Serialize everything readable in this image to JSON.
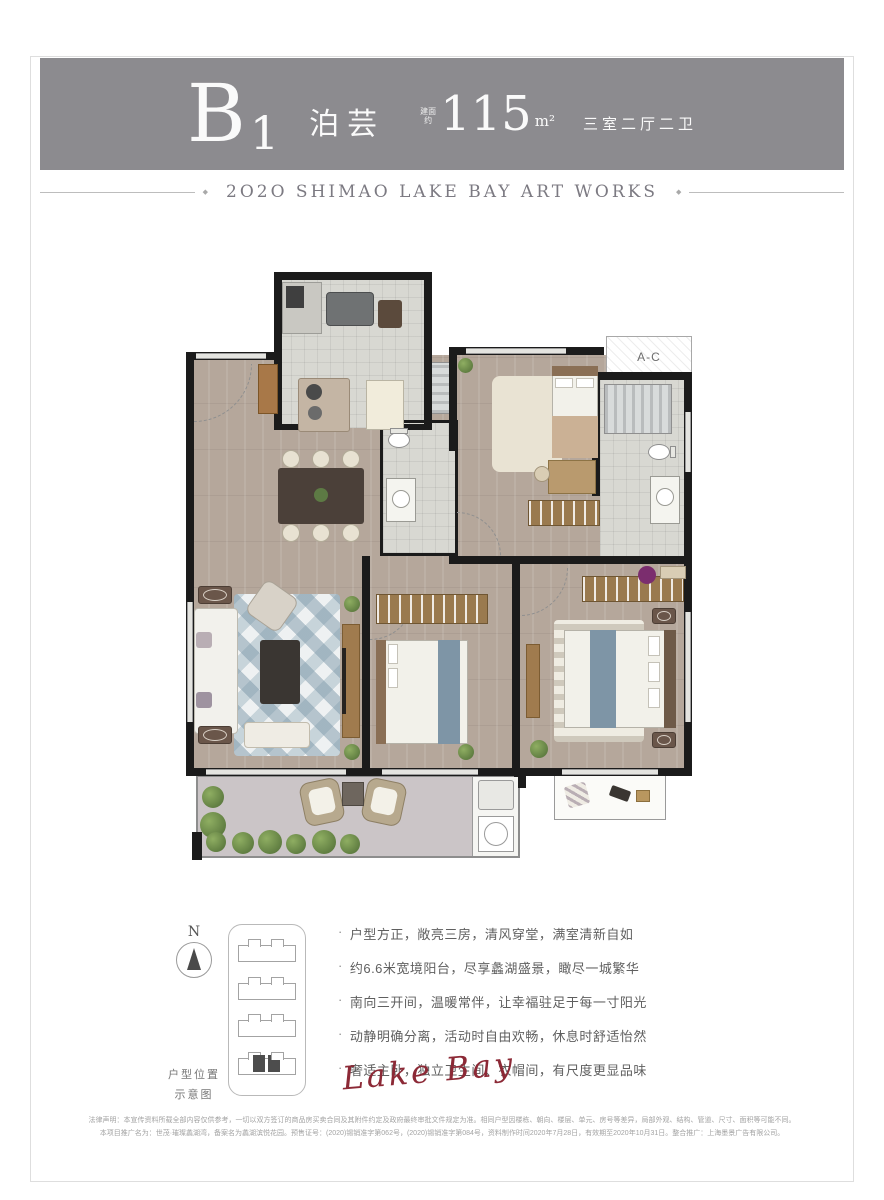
{
  "header": {
    "unit_main": "B",
    "unit_sub": "1",
    "name": "泊芸",
    "area_prefix": "建面约",
    "area_value": "115",
    "area_unit": "m²",
    "rooms": "三室二厅二卫"
  },
  "subtitle": {
    "diamond": "◆",
    "text": "2O2O SHIMAO LAKE BAY ART WORKS"
  },
  "plan": {
    "ac_label": "A-C"
  },
  "compass": {
    "label": "N"
  },
  "keyplan": {
    "caption_line1": "户型位置",
    "caption_line2": "示意图"
  },
  "features": {
    "bullet": "·",
    "items": [
      "户型方正，敞亮三房，清风穿堂，满室清新自如",
      "约6.6米宽境阳台，尽享蠡湖盛景，瞰尽一城繁华",
      "南向三开间，温暖常伴，让幸福驻足于每一寸阳光",
      "动静明确分离，活动时自由欢畅，休息时舒适怡然",
      "奢适主卧，独立卫生间、衣帽间，有尺度更显品味"
    ]
  },
  "signature": "Lake Bay",
  "legal": {
    "line1": "法律声明：本宣传资料所载全部内容仅供参考，一切以双方签订的商品房买卖合同及其附件约定及政府最终审批文件规定为准。相同户型因楼栋、朝向、楼层、单元、房号等差异，局部外观、结构、管道、尺寸、面积等可能不同。",
    "line2": "本项目推广名为：世茂·璀璨蠡湖湾，备案名为蠡湖滨悦花园。预售证号：(2020)锡销准字第062号，(2020)锡销准字第084号，资料制作时间2020年7月28日，有效期至2020年10月31日。整合推广：上海墨景广告有限公司。"
  },
  "colors": {
    "band": "#8c8b8f",
    "signature_red": "#8c2936"
  }
}
